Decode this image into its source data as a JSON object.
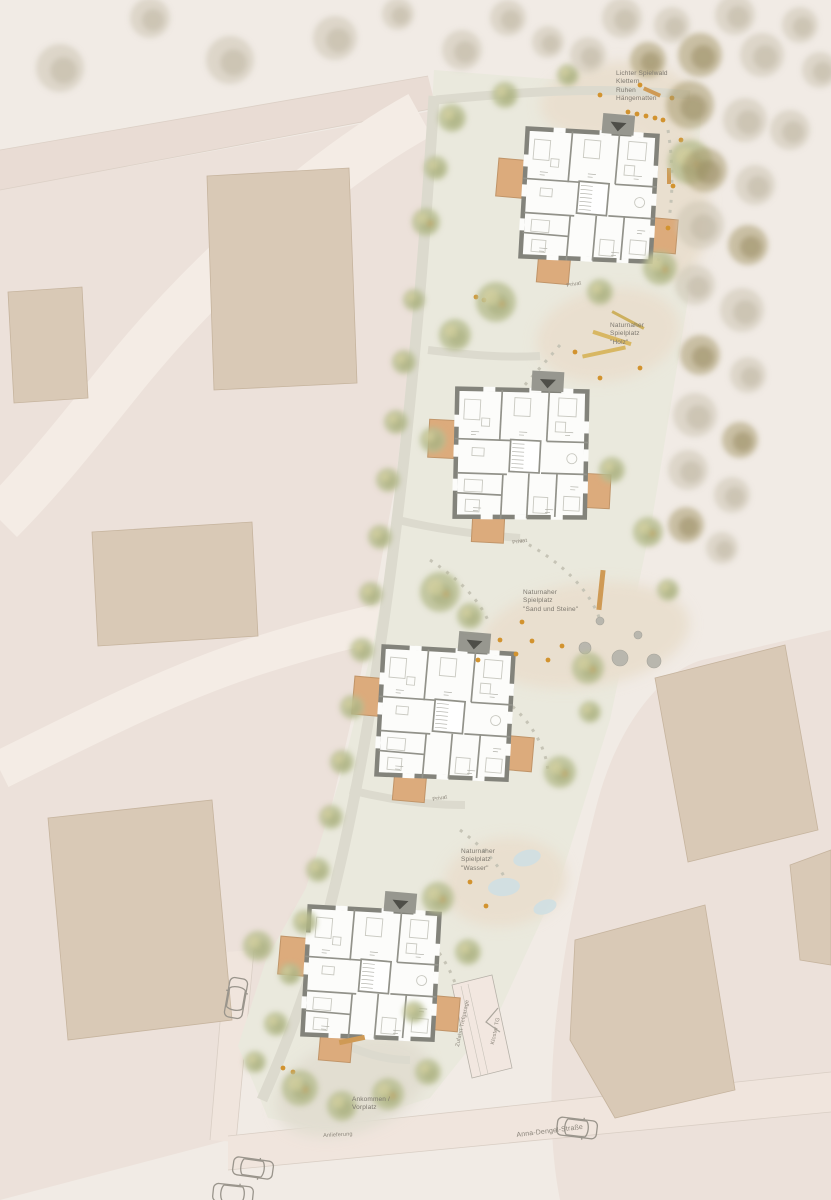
{
  "palette": {
    "background": "#f1ebe5",
    "paved_pink": "#ece1da",
    "road_band": "#e9dcd4",
    "road_light": "#f4ece5",
    "site_green": "#eae9dd",
    "sand": "#e9dfcf",
    "path_gray": "#dcdace",
    "existing_building": "#d9c9b6",
    "plan_wall": "#83837b",
    "balcony": "#dcab7c",
    "play_orange": "#d2932f",
    "tree_green": "#b8bd90",
    "tree_forest": "#ccc4b2",
    "tree_olive": "#a79a6e",
    "water": "#cfdfe2",
    "text": "#7d786f"
  },
  "annotations": [
    {
      "id": "spielwald",
      "x": 616,
      "y": 70,
      "rot": 0,
      "cls": "",
      "lines": [
        "Lichter Spielwald",
        "Klettern",
        "Ruhen",
        "Hängematten"
      ]
    },
    {
      "id": "holz",
      "x": 610,
      "y": 322,
      "rot": 0,
      "cls": "",
      "lines": [
        "Naturnaher",
        "Spielplatz",
        "\"Holz\""
      ]
    },
    {
      "id": "sand-steine",
      "x": 523,
      "y": 589,
      "rot": 0,
      "cls": "",
      "lines": [
        "Naturnaher",
        "Spielplatz",
        "\"Sand und Steine\""
      ]
    },
    {
      "id": "wasser",
      "x": 461,
      "y": 848,
      "rot": 0,
      "cls": "",
      "lines": [
        "Naturnaher",
        "Spielplatz",
        "\"Wasser\""
      ]
    },
    {
      "id": "ankommen",
      "x": 352,
      "y": 1096,
      "rot": 0,
      "cls": "",
      "lines": [
        "Ankommen /",
        "Vorplatz"
      ]
    },
    {
      "id": "anlieferung",
      "x": 323,
      "y": 1133,
      "rot": -3,
      "cls": "tiny",
      "lines": [
        "Anlieferung"
      ]
    },
    {
      "id": "strasse",
      "x": 516,
      "y": 1131,
      "rot": -7,
      "cls": "street-label",
      "lines": [
        "Anna-Dengel-Straße"
      ]
    },
    {
      "id": "privat-1",
      "x": 566,
      "y": 283,
      "rot": -10,
      "cls": "tiny",
      "lines": [
        "Privat"
      ]
    },
    {
      "id": "privat-2",
      "x": 512,
      "y": 540,
      "rot": -8,
      "cls": "tiny",
      "lines": [
        "Privat"
      ]
    },
    {
      "id": "privat-3",
      "x": 432,
      "y": 797,
      "rot": -10,
      "cls": "tiny",
      "lines": [
        "Privat"
      ]
    },
    {
      "id": "tg-zufahrt",
      "x": 455,
      "y": 1046,
      "rot": -78,
      "cls": "tiny",
      "lines": [
        "Zufahrt Tiefgarage"
      ]
    },
    {
      "id": "tg-kloster",
      "x": 490,
      "y": 1044,
      "rot": -78,
      "cls": "tiny",
      "lines": [
        "Kloster TG"
      ]
    }
  ],
  "map": {
    "buildings": [
      {
        "x": 588,
        "y": 196,
        "rot": 5
      },
      {
        "x": 520,
        "y": 454,
        "rot": 3
      },
      {
        "x": 444,
        "y": 714,
        "rot": 5
      },
      {
        "x": 370,
        "y": 974,
        "rot": 5
      }
    ],
    "cars": [
      [
        236,
        998,
        10
      ],
      [
        253,
        1168,
        98
      ],
      [
        577,
        1128,
        97
      ],
      [
        233,
        1194,
        96
      ]
    ],
    "forest_trees": [
      [
        60,
        68,
        24,
        0
      ],
      [
        150,
        18,
        20,
        0
      ],
      [
        230,
        60,
        24,
        0
      ],
      [
        335,
        38,
        22,
        0
      ],
      [
        398,
        14,
        16,
        0
      ],
      [
        462,
        50,
        20,
        0
      ],
      [
        508,
        18,
        18,
        0
      ],
      [
        548,
        42,
        16,
        0
      ],
      [
        588,
        55,
        18,
        0
      ],
      [
        622,
        18,
        20,
        0
      ],
      [
        648,
        60,
        18,
        1
      ],
      [
        672,
        25,
        18,
        0
      ],
      [
        700,
        55,
        22,
        1
      ],
      [
        735,
        15,
        20,
        0
      ],
      [
        762,
        55,
        22,
        0
      ],
      [
        800,
        25,
        18,
        0
      ],
      [
        820,
        70,
        18,
        0
      ],
      [
        690,
        105,
        24,
        1
      ],
      [
        745,
        120,
        22,
        0
      ],
      [
        790,
        130,
        20,
        0
      ],
      [
        705,
        170,
        22,
        1
      ],
      [
        755,
        185,
        20,
        0
      ],
      [
        700,
        225,
        24,
        0
      ],
      [
        748,
        245,
        20,
        1
      ],
      [
        695,
        285,
        20,
        0
      ],
      [
        742,
        310,
        22,
        0
      ],
      [
        700,
        355,
        20,
        1
      ],
      [
        748,
        375,
        18,
        0
      ],
      [
        695,
        415,
        22,
        0
      ],
      [
        740,
        440,
        18,
        1
      ],
      [
        688,
        470,
        20,
        0
      ],
      [
        732,
        495,
        18,
        0
      ],
      [
        686,
        525,
        18,
        1
      ],
      [
        722,
        548,
        16,
        0
      ]
    ],
    "green_trees": [
      [
        452,
        118,
        14,
        0
      ],
      [
        436,
        168,
        12,
        0
      ],
      [
        426,
        222,
        14,
        1
      ],
      [
        505,
        95,
        13,
        0
      ],
      [
        568,
        75,
        11,
        0
      ],
      [
        690,
        162,
        22,
        1
      ],
      [
        660,
        268,
        17,
        1
      ],
      [
        600,
        292,
        13,
        0
      ],
      [
        496,
        302,
        20,
        1
      ],
      [
        455,
        335,
        16,
        0
      ],
      [
        414,
        300,
        11,
        0
      ],
      [
        404,
        362,
        12,
        0
      ],
      [
        396,
        422,
        12,
        0
      ],
      [
        433,
        440,
        13,
        0
      ],
      [
        388,
        480,
        12,
        0
      ],
      [
        380,
        537,
        12,
        0
      ],
      [
        612,
        470,
        13,
        0
      ],
      [
        648,
        532,
        15,
        1
      ],
      [
        440,
        592,
        20,
        1
      ],
      [
        470,
        616,
        13,
        0
      ],
      [
        371,
        594,
        12,
        0
      ],
      [
        362,
        650,
        12,
        0
      ],
      [
        588,
        668,
        16,
        1
      ],
      [
        668,
        590,
        11,
        0
      ],
      [
        352,
        707,
        12,
        0
      ],
      [
        342,
        762,
        12,
        0
      ],
      [
        560,
        772,
        16,
        1
      ],
      [
        590,
        712,
        11,
        0
      ],
      [
        331,
        817,
        12,
        0
      ],
      [
        318,
        870,
        12,
        0
      ],
      [
        305,
        922,
        12,
        0
      ],
      [
        258,
        946,
        15,
        0
      ],
      [
        438,
        898,
        16,
        1
      ],
      [
        468,
        952,
        13,
        0
      ],
      [
        290,
        974,
        11,
        0
      ],
      [
        276,
        1024,
        12,
        0
      ],
      [
        414,
        1012,
        11,
        0
      ],
      [
        300,
        1088,
        18,
        1
      ],
      [
        342,
        1106,
        15,
        0
      ],
      [
        388,
        1094,
        16,
        1
      ],
      [
        428,
        1072,
        13,
        0
      ],
      [
        255,
        1062,
        11,
        0
      ]
    ],
    "playground": {
      "dots": [
        [
          600,
          95
        ],
        [
          640,
          85
        ],
        [
          672,
          98
        ],
        [
          681,
          140
        ],
        [
          673,
          186
        ],
        [
          668,
          228
        ],
        [
          628,
          112
        ],
        [
          637,
          114
        ],
        [
          646,
          116
        ],
        [
          655,
          118
        ],
        [
          663,
          120
        ],
        [
          575,
          352
        ],
        [
          640,
          368
        ],
        [
          600,
          378
        ],
        [
          500,
          640
        ],
        [
          516,
          654
        ],
        [
          532,
          641
        ],
        [
          548,
          660
        ],
        [
          562,
          646
        ],
        [
          522,
          622
        ],
        [
          478,
          660
        ],
        [
          470,
          882
        ],
        [
          486,
          906
        ],
        [
          283,
          1068
        ],
        [
          293,
          1072
        ],
        [
          476,
          297
        ],
        [
          484,
          300
        ]
      ],
      "boulders": [
        [
          585,
          648,
          6
        ],
        [
          620,
          658,
          8
        ],
        [
          654,
          661,
          7
        ],
        [
          600,
          621,
          4
        ],
        [
          638,
          635,
          4
        ]
      ],
      "rects": [
        [
          601,
          590,
          5,
          40,
          6,
          "#cf9a55"
        ],
        [
          612,
          338,
          40,
          4,
          18,
          "#d8b763"
        ],
        [
          604,
          352,
          44,
          4,
          -12,
          "#d8b763"
        ],
        [
          628,
          320,
          36,
          3,
          28,
          "#cdb05e"
        ],
        [
          352,
          1040,
          26,
          5,
          -12,
          "#cf9a55"
        ],
        [
          652,
          92,
          18,
          4,
          24,
          "#cf9a55"
        ],
        [
          669,
          176,
          4,
          16,
          0,
          "#cf9a55"
        ]
      ],
      "water": [
        [
          527,
          858,
          14,
          8,
          -15
        ],
        [
          504,
          887,
          16,
          9,
          -5
        ],
        [
          545,
          907,
          12,
          7,
          -20
        ]
      ]
    }
  }
}
